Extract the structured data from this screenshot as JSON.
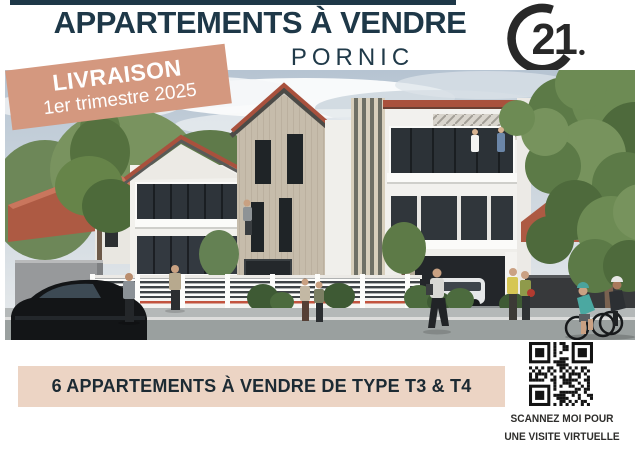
{
  "header": {
    "title": "APPARTEMENTS À VENDRE",
    "city": "PORNIC"
  },
  "logo": {
    "text": "21",
    "name_hint": "century-21-seal"
  },
  "banner": {
    "line1": "LIVRAISON",
    "line2": "1er trimestre 2025"
  },
  "strip": {
    "text": "6 APPARTEMENTS À VENDRE DE TYPE T3 & T4"
  },
  "qr": {
    "caption_line1": "SCANNEZ MOI POUR",
    "caption_line2": "UNE VISITE VIRTUELLE"
  },
  "colors": {
    "navy_text": "#1e3848",
    "banner_salmon": "#d4987f",
    "strip_peach": "#ecd4c4",
    "logo_dark": "#282828",
    "roof_tile": "#a9513d",
    "red_fence_line": "#c2543f"
  }
}
